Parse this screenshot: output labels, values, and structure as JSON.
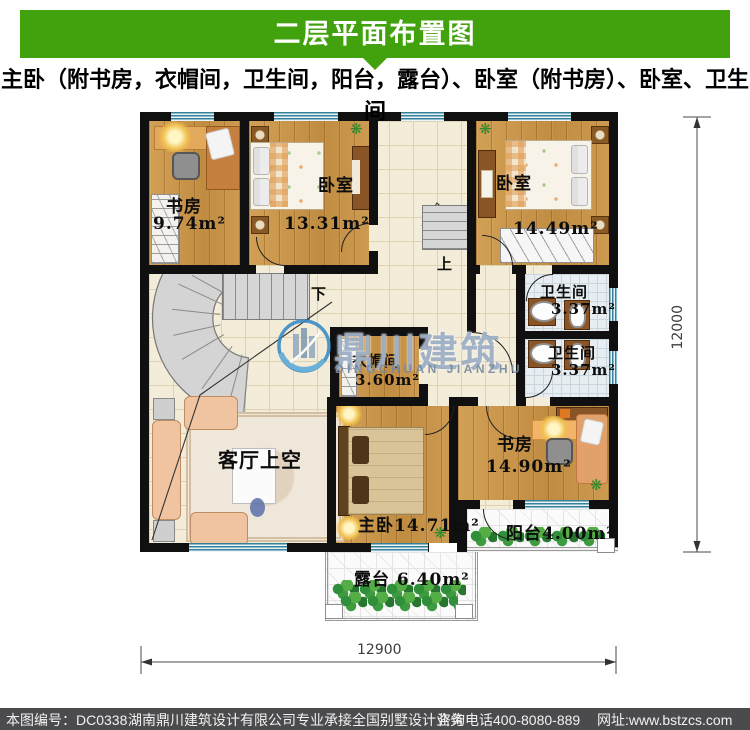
{
  "header": {
    "title": "二层平面布置图"
  },
  "subtitle": "主卧（附书房，衣帽间，卫生间，阳台，露台）、卧室（附书房）、卧室、卫生间",
  "plan": {
    "rooms": {
      "study_top": {
        "name": "书房",
        "area": "9.74m²"
      },
      "bedroom_left": {
        "name": "卧室",
        "area": "13.31m²"
      },
      "bedroom_right": {
        "name": "卧室",
        "area": "14.49m²"
      },
      "bath_upper": {
        "name": "卫生间",
        "area": "3.37m²"
      },
      "bath_lower": {
        "name": "卫生间",
        "area": "3.37m²"
      },
      "cloakroom": {
        "name": "衣帽间",
        "area": "3.60m²"
      },
      "study_bottom": {
        "name": "书房",
        "area": "14.90m²"
      },
      "living_void": {
        "name": "客厅上空"
      },
      "master": {
        "label": "主卧14.71m²"
      },
      "balcony": {
        "label": "阳台4.00m²"
      },
      "terrace": {
        "label": "露台 6.40m²"
      }
    },
    "stairs": {
      "up": "上",
      "down": "下"
    },
    "dimensions": {
      "bottom": "12900",
      "right": "12000"
    }
  },
  "watermark": {
    "cn": "鼎川建筑",
    "en": "DINGCHUAN JIANZHU"
  },
  "footer": {
    "plan_number": "本图编号：DC0338",
    "company": "湖南鼎川建筑设计有限公司专业承接全国别墅设计业务",
    "phone": "咨询电话400-8080-889",
    "website": "网址:www.bstzcs.com"
  },
  "colors": {
    "banner_green": "#42a20e",
    "footer_bg": "#4b4b4d",
    "wall": "#101010",
    "window_blue": "#35809b",
    "watermark_blue": "#2f86c4"
  }
}
